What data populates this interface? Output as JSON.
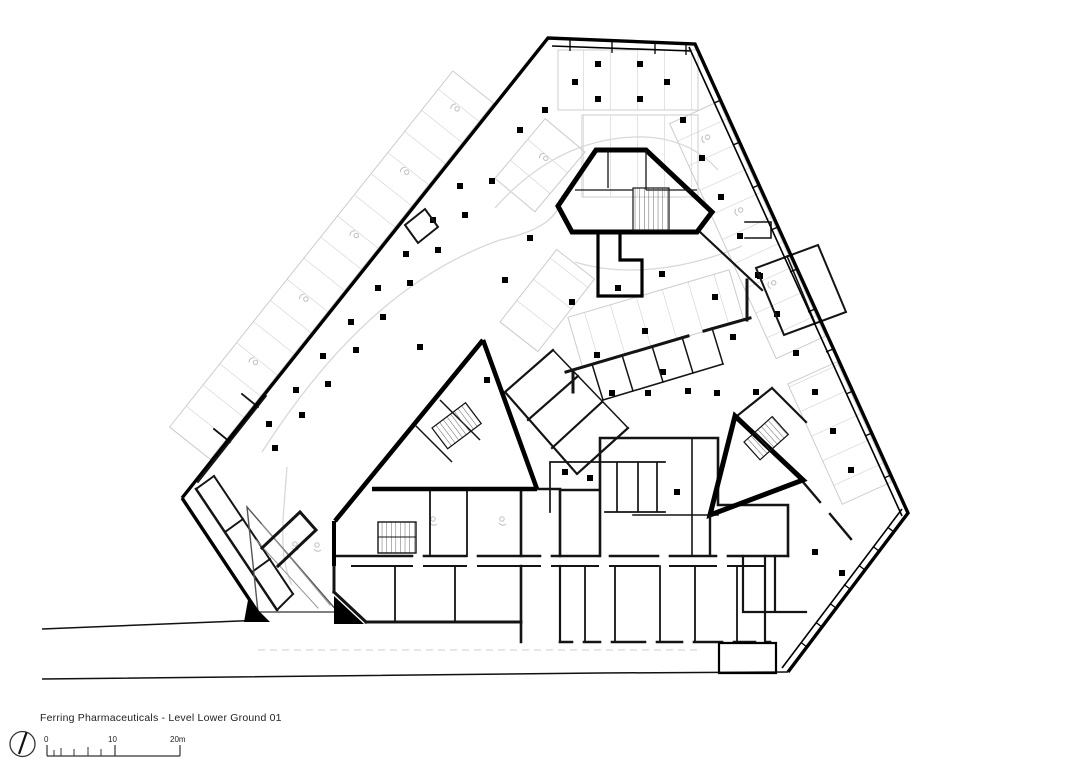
{
  "title_block": {
    "title": "Ferring Pharmaceuticals - Level Lower Ground 01"
  },
  "scale_bar": {
    "tick_0": "0",
    "tick_10": "10",
    "tick_20": "20m"
  },
  "icons": {
    "north_arrow": "north-arrow-icon",
    "stall_glyph": "accessible-parking-icon"
  },
  "colors": {
    "heavy_wall": "#000000",
    "medium_wall": "#141414",
    "parking_stall_line": "#cccccc",
    "aisle_marking": "#d8d8d8",
    "background": "#ffffff"
  }
}
